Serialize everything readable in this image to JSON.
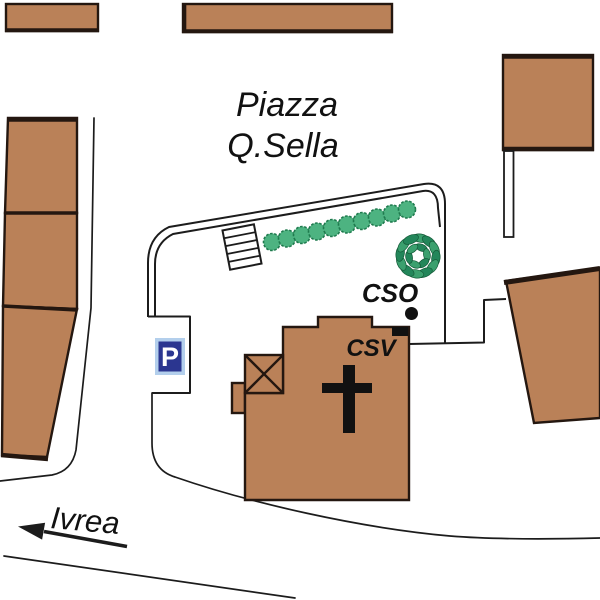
{
  "title": {
    "line1": "Piazza",
    "line2": "Q.Sella"
  },
  "labels": {
    "cso": "CSO",
    "csv": "CSV",
    "parking": "P",
    "road_destination": "Ivrea"
  },
  "markers": {
    "cso_marker": "black-dot",
    "csv_marker": "black-square",
    "tree_row_count": 10
  },
  "colors": {
    "building_fill": "#BA8158",
    "building_stroke": "#241710",
    "line_color": "#1c1c1c",
    "text_color": "#111111",
    "marker_color": "#111111",
    "tree_small_fill": "#4DB381",
    "tree_small_stroke": "#1F7A4E",
    "tree_large_leaf": "#3BA06E",
    "tree_large_leaf2": "#23865A",
    "tree_large_stroke": "#155B39",
    "parking_bg": "#2B3690",
    "parking_border": "#B3CFEC",
    "parking_letter": "#FFFFFF",
    "background": "#FFFFFF"
  }
}
